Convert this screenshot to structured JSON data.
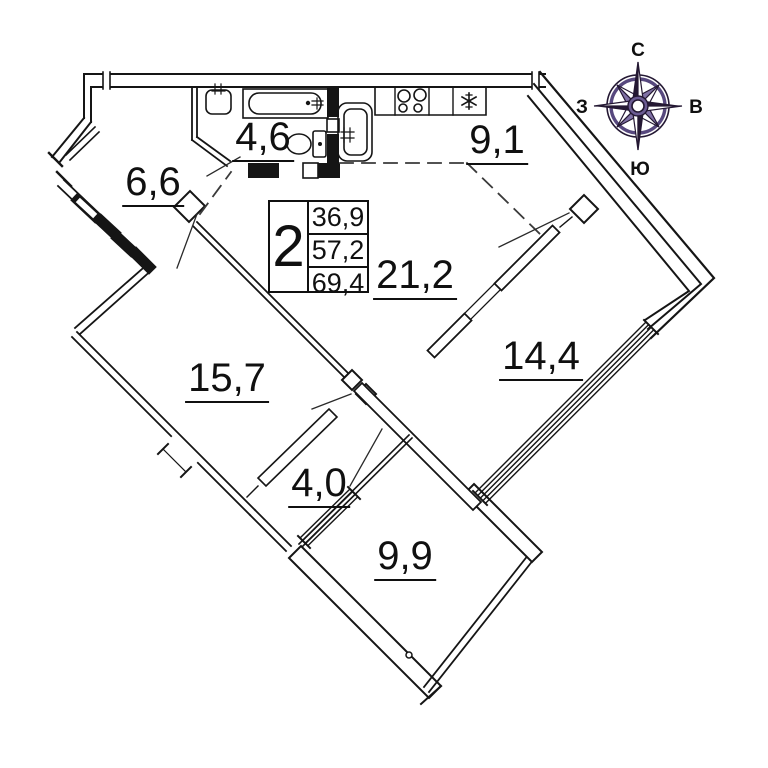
{
  "info_box": {
    "room_count": "2",
    "areas": [
      "36,9",
      "57,2",
      "69,4"
    ]
  },
  "room_labels": {
    "bathroom": "4,6",
    "hall": "6,6",
    "kitchen": "9,1",
    "living": "21,2",
    "bedroom_left": "15,7",
    "bedroom_right": "14,4",
    "corridor": "4,0",
    "bedroom_bottom": "9,9"
  },
  "compass": {
    "labels": {
      "north": "С",
      "east": "В",
      "south": "Ю",
      "west": "З"
    },
    "colors": {
      "ring_dark": "#241833",
      "ring_purple": "#57487e",
      "star_light": "#8071a5",
      "hub": "#6b5b92"
    }
  },
  "fixtures": [
    "wash-basin",
    "bathtub",
    "toilet",
    "kitchen-sink",
    "stove",
    "refrigerator"
  ],
  "colors": {
    "walls": "#151515",
    "dashed": "#3a3a3a",
    "leader": "#2a2a2a"
  }
}
